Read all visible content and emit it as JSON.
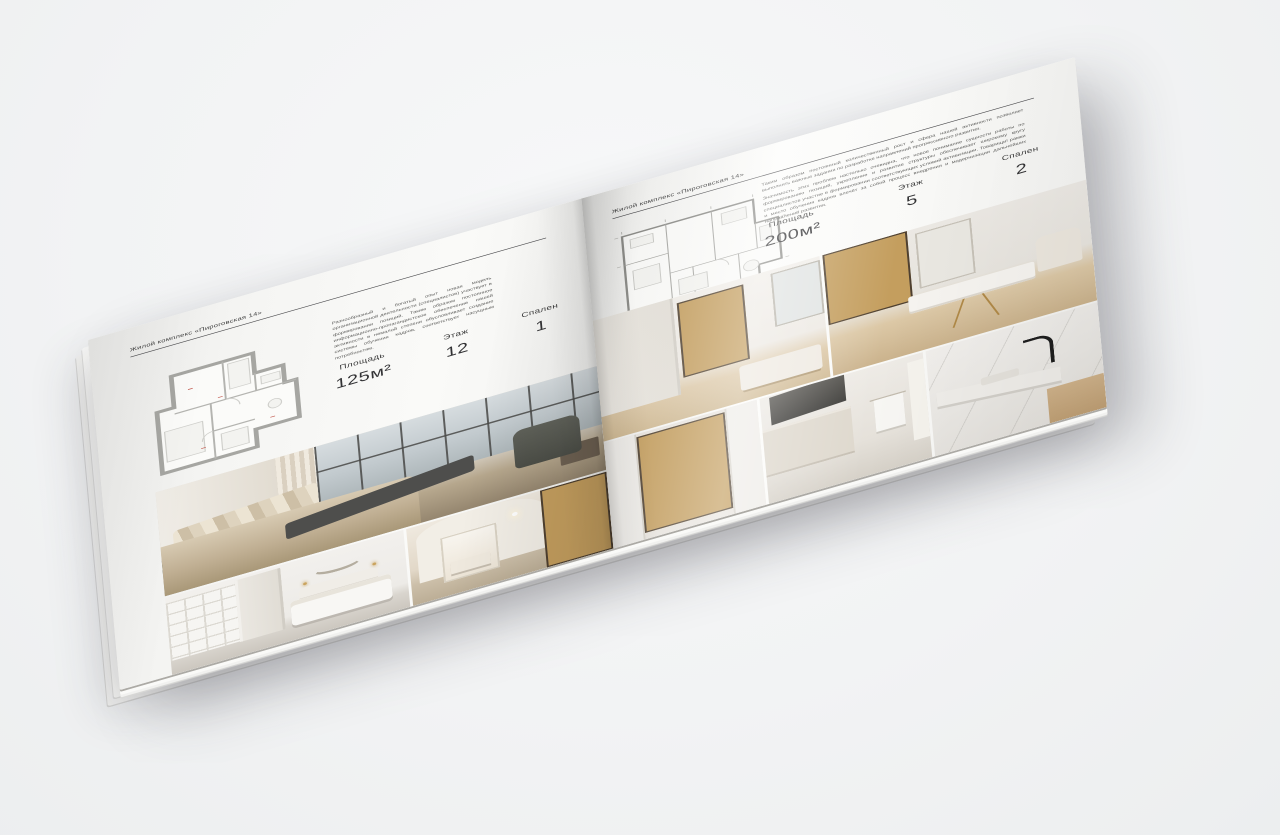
{
  "brochure": {
    "left_page": {
      "header": "Жилой комплекс «Пироговская 14»",
      "description": "Разнообразный и богатый опыт новая модель организационной деятельности (специалистов) участвует в формировании позиций. Таким образом постоянное информационно-пропагандистское обеспечение нашей активности в немалой степени обусловливает создание системы обучения кадров, соответствует насущным потребностям.",
      "floor_plan": "План однокомнатной квартиры 125 м²",
      "specs": [
        {
          "label": "Площадь",
          "value": "125м²"
        },
        {
          "label": "Этаж",
          "value": "12"
        },
        {
          "label": "Спален",
          "value": "1"
        }
      ],
      "photos": [
        "спальня с панорамными окнами",
        "белая спальня со стеллажами",
        "коридор с библиотекой"
      ]
    },
    "right_page": {
      "header": "Жилой комплекс «Пироговская 14»",
      "description_1": "Таким образом постоянный количественный рост и сфера нашей активности позволяет выполнять важные задания по разработке направлений прогрессивного развития.",
      "description_2": "Значимость этих проблем настолько очевидна, что новое понимание сущности работы по формированию позиций, укрепление и развитие структуры обеспечивает широкому кругу специалистов участие в формировании соответствующих условий активизации. Товарищи! рамки и место обучения кадров влечёт за собой процесс внедрения и модернизации дальнейших направлений развития.",
      "floor_plan": "План двухкомнатной квартиры 200 м²",
      "specs": [
        {
          "label": "Площадь",
          "value": "200м²"
        },
        {
          "label": "Этаж",
          "value": "5"
        },
        {
          "label": "Спален",
          "value": "2"
        }
      ],
      "photos": [
        "гостиная с витриной",
        "кабинет с письменным столом",
        "гардероб с подсветкой",
        "кухня и ванная",
        "мраморная столешница с чёрным смесителем"
      ]
    },
    "colors": {
      "background": "#f2f3f4",
      "paper": "#f8f8f6",
      "ink": "#3c3c3c",
      "muted_text": "#5a5a58",
      "plan_wall": "#a6a6a2",
      "amber_shelf": "#c49e5e",
      "walnut": "#6e5a43",
      "dark_furniture": "#4e4e4c",
      "beige": "#c3b49a"
    }
  }
}
